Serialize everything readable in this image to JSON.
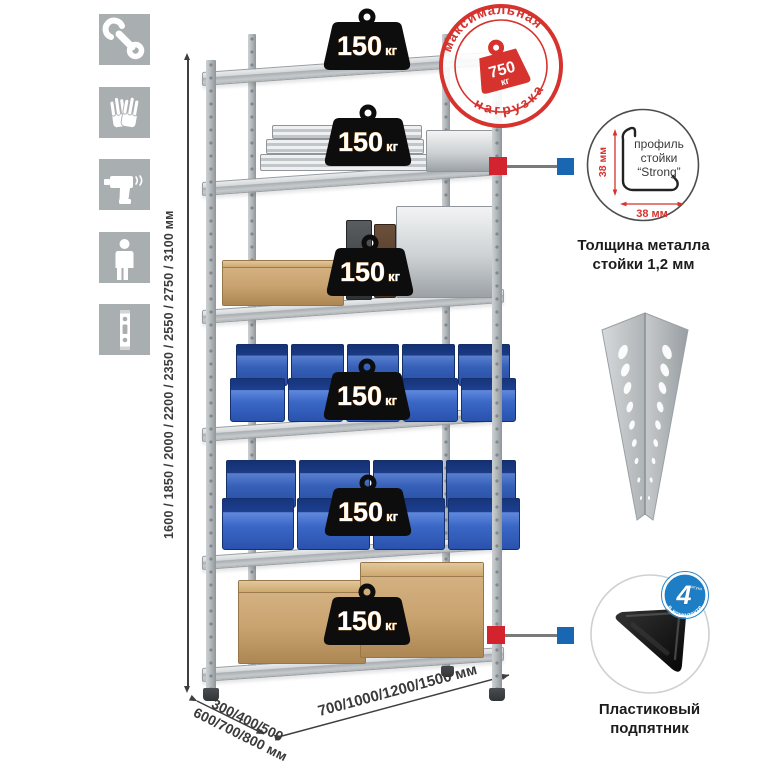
{
  "instruction_icons": [
    {
      "name": "wrench"
    },
    {
      "name": "gloves"
    },
    {
      "name": "drill"
    },
    {
      "name": "person"
    },
    {
      "name": "upright-post"
    }
  ],
  "height_dimension": {
    "label": "1600 / 1850 / 2000 / 2200 / 2350 / 2550 / 2750 / 3100 мм"
  },
  "depth_dimension": {
    "line1": "300/400/500",
    "line2": "600/700/800 мм"
  },
  "width_dimension": {
    "label": "700/1000/1200/1500 мм"
  },
  "shelf_load_badge": {
    "value": "150",
    "unit": "кг"
  },
  "max_load_stamp": {
    "arc_top": "максимальная",
    "arc_bottom": "нагрузка",
    "value": "750",
    "unit": "кг"
  },
  "profile_callout": {
    "line1": "профиль",
    "line2": "стойки",
    "line3": "“Strong”",
    "height_dim": "38 мм",
    "width_dim": "38 мм",
    "caption1": "Толщина металла",
    "caption2": "стойки 1,2 мм"
  },
  "foot_callout": {
    "badge_number": "4",
    "badge_units": "штуки",
    "badge_arc": "в комплекте",
    "caption1": "Пластиковый",
    "caption2": "подпятник"
  },
  "colors": {
    "stamp_red": "#d6332e",
    "connector_red": "#d2232e",
    "connector_blue": "#1967b3",
    "icon_gray": "#a9aeb1",
    "bin_blue": "#2e62c4"
  }
}
